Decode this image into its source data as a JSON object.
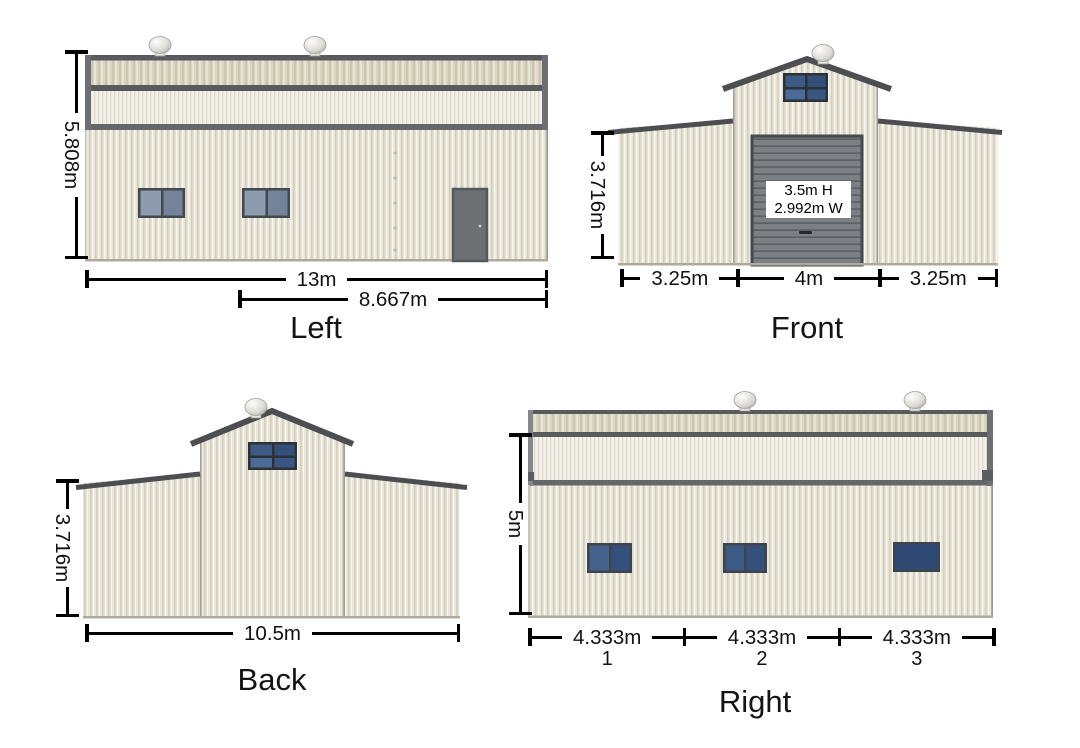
{
  "views": {
    "left": {
      "label": "Left",
      "dims": {
        "height": "5.808m",
        "total_width": "13m",
        "partial_width": "8.667m"
      }
    },
    "front": {
      "label": "Front",
      "dims": {
        "height": "3.716m",
        "bays": [
          "3.25m",
          "4m",
          "3.25m"
        ]
      },
      "garage_door": {
        "line1": "3.5m H",
        "line2": "2.992m W"
      }
    },
    "back": {
      "label": "Back",
      "dims": {
        "height": "3.716m",
        "total_width": "10.5m"
      }
    },
    "right": {
      "label": "Right",
      "dims": {
        "height": "5m",
        "bays": [
          "4.333m",
          "4.333m",
          "4.333m"
        ],
        "bay_numbers": [
          "1",
          "2",
          "3"
        ]
      }
    }
  },
  "colors": {
    "background": "#ffffff",
    "wall": "#e7e4d6",
    "roof_band": "#d9d5c1",
    "clerestory": "#f2f1e9",
    "trim": "#595a5e",
    "window_glass": "#33517c",
    "personnel_door": "#6d7073",
    "garage_door": "#7c7f83",
    "dimension_lines": "#000000"
  }
}
